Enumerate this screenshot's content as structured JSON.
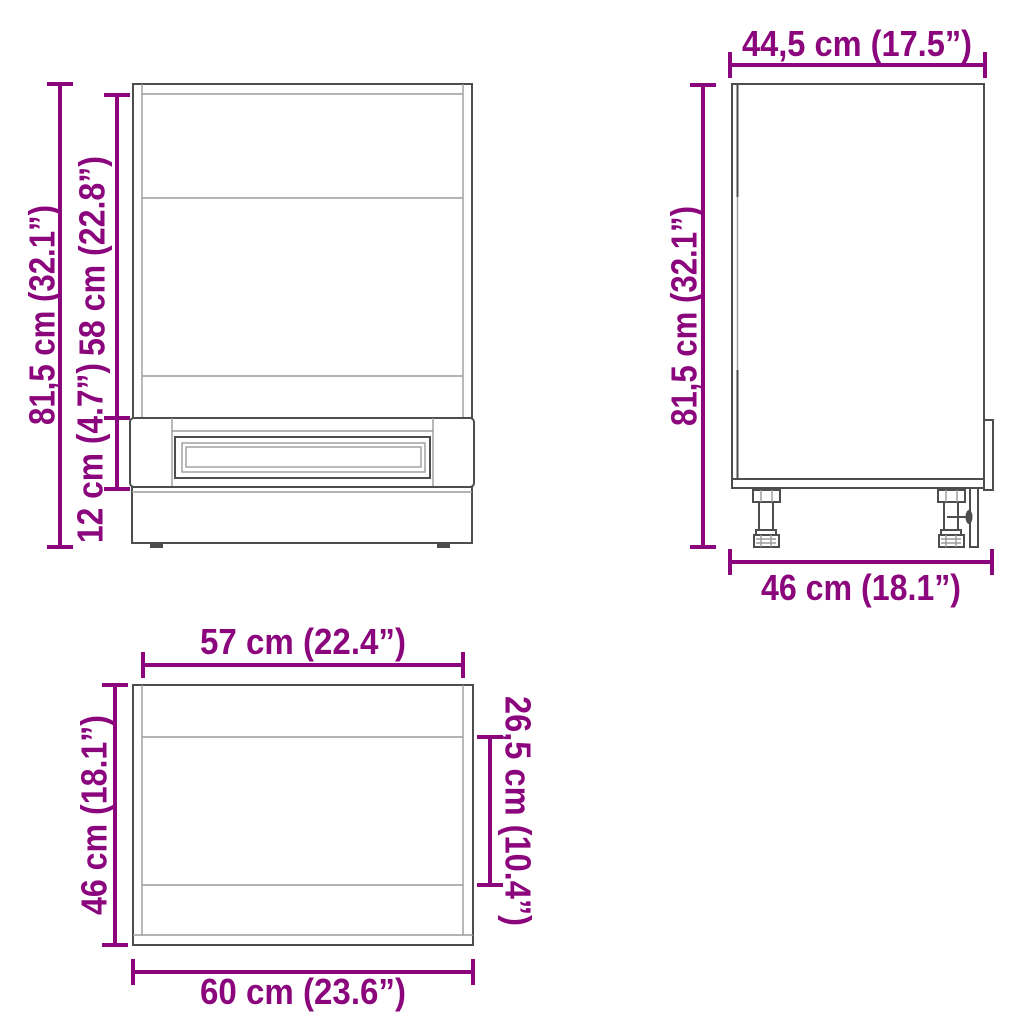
{
  "diagram": {
    "accent_color": "#8B067C",
    "line_color": "#4D4D4D",
    "front_view": {
      "total_height": "81,5 cm (32.1”)",
      "upper_section_height": "58 cm (22.8”)",
      "drawer_section_height": "12 cm (4.7”)"
    },
    "side_view": {
      "top_depth": "44,5 cm (17.5”)",
      "total_height": "81,5 cm (32.1”)",
      "bottom_depth": "46 cm (18.1”)"
    },
    "top_view": {
      "inner_width": "57 cm (22.4”)",
      "side_depth": "46 cm (18.1”)",
      "opening_depth": "26,5 cm (10.4”)",
      "outer_width": "60 cm (23.6”)"
    }
  }
}
